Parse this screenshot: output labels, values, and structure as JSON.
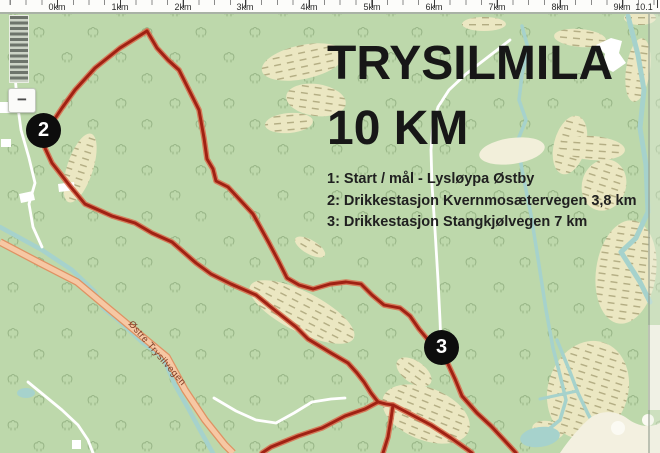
{
  "scale_bar": {
    "labels": [
      "0km",
      "1km",
      "2km",
      "3km",
      "4km",
      "5km",
      "6km",
      "7km",
      "8km",
      "9km",
      "10.1"
    ]
  },
  "zoom_control": {
    "zoom_out": "−"
  },
  "title": {
    "line1": "TRYSILMILA",
    "line2": "10 KM"
  },
  "legend": {
    "items": [
      "1: Start / mål - Lysløypa Østby",
      "2: Drikkestasjon Kvernmosætervegen 3,8 km",
      "3: Drikkestasjon Stangkjølvegen 7 km"
    ]
  },
  "map": {
    "road_label": "Østre Trysilvegen",
    "markers": [
      {
        "number": "2"
      },
      {
        "number": "3"
      }
    ],
    "colors": {
      "background_green": "#bdd8ab",
      "route_red": "#a02113",
      "road_salmon": "#f6c8a4",
      "water_teal": "#a6d2cc",
      "marsh_tan": "#ebe7c2",
      "marker_black": "#0d0d0d"
    }
  }
}
